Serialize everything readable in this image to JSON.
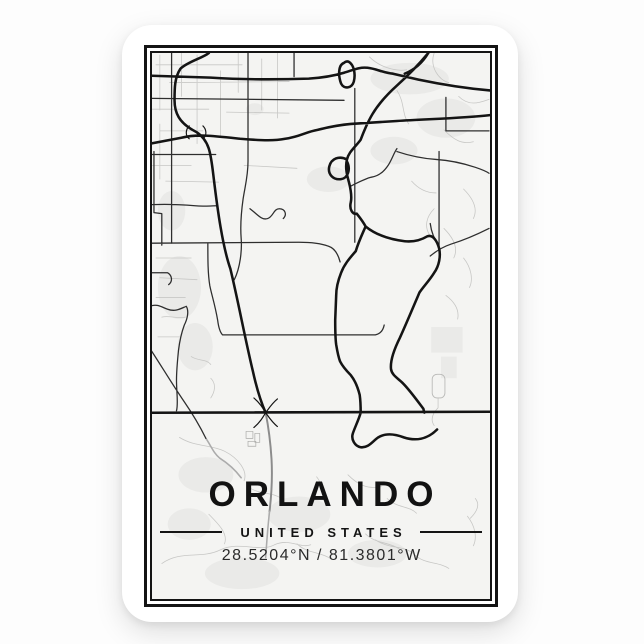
{
  "poster": {
    "title": "ORLANDO",
    "subtitle": "UNITED STATES",
    "coordinates": "28.5204°N / 81.3801°W"
  },
  "colors": {
    "page_background": "#fdfdfd",
    "card_background": "#ffffff",
    "frame": "#141414",
    "map_background": "#f4f4f2",
    "road_major": "#141414",
    "road_medium": "#2e2e2e",
    "road_minor": "#c7c7c5",
    "land_patch": "#eaeae8",
    "text": "#121212"
  }
}
